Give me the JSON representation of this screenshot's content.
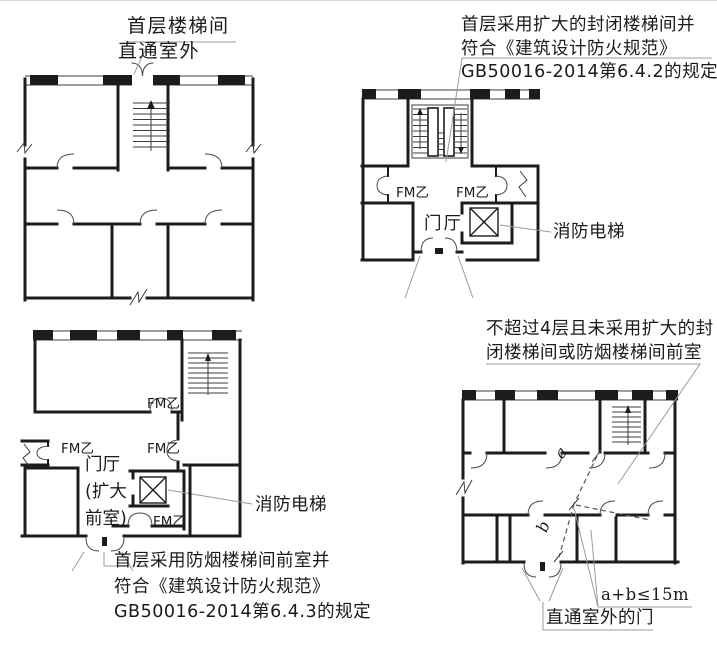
{
  "colors": {
    "background": "#ffffff",
    "wall_line": "#1c1c1c",
    "leader_line": "#9b9b9b",
    "text": "#1b1b1b"
  },
  "diagrams": {
    "top_left": {
      "callout_lines": [
        "首层楼梯间",
        "直通室外"
      ]
    },
    "top_right": {
      "callout_lines": [
        "首层采用扩大的封闭楼梯间并",
        "符合《建筑设计防火规范》",
        "GB50016-2014第6.4.2的规定"
      ],
      "door_labels": [
        "FM乙",
        "FM乙"
      ],
      "hall_label": "门厅",
      "elevator_label": "消防电梯"
    },
    "bottom_left": {
      "door_labels": [
        "FM乙",
        "FM乙",
        "FM乙",
        "FM乙"
      ],
      "hall_label_lines": [
        "门厅",
        "(扩大",
        "前室)"
      ],
      "elevator_label": "消防电梯",
      "callout_lines": [
        "首层采用防烟楼梯间前室并",
        "符合《建筑设计防火规范》",
        "GB50016-2014第6.4.3的规定"
      ]
    },
    "bottom_right": {
      "callout_lines": [
        "不超过4层且未采用扩大的封",
        "闭楼梯间或防烟楼梯间前室"
      ],
      "path_label_a": "a",
      "path_label_b": "b",
      "distance_rule": "a+b≤15m",
      "exit_door_label": "直通室外的门"
    }
  }
}
